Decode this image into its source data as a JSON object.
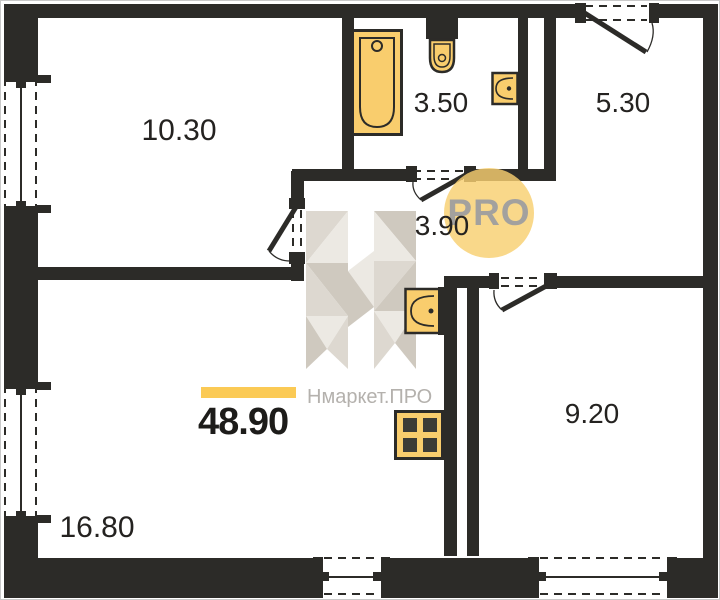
{
  "plan": {
    "rooms": [
      {
        "id": "room-top-left",
        "area": "10.30"
      },
      {
        "id": "bathroom",
        "area": "3.50"
      },
      {
        "id": "entrance-hall",
        "area": "5.30"
      },
      {
        "id": "corridor",
        "area": "3.90"
      },
      {
        "id": "room-bottom-right",
        "area": "9.20"
      },
      {
        "id": "kitchen-living",
        "area": "16.80"
      }
    ],
    "total_area": "48.90",
    "fixtures": [
      "bathtub",
      "toilet",
      "washbasin",
      "kitchen-sink",
      "stove"
    ]
  },
  "brand": {
    "watermark_letter": "Н",
    "watermark_text": "Нмаркет.ПРО",
    "pro_badge": "PRO"
  },
  "colors": {
    "wall": "#2c2b28",
    "fixture_fill": "#f9cd6d",
    "accent_bar": "#fbca55",
    "pro_circle": "#f8cf70",
    "watermark_gray": "#dedacf"
  }
}
